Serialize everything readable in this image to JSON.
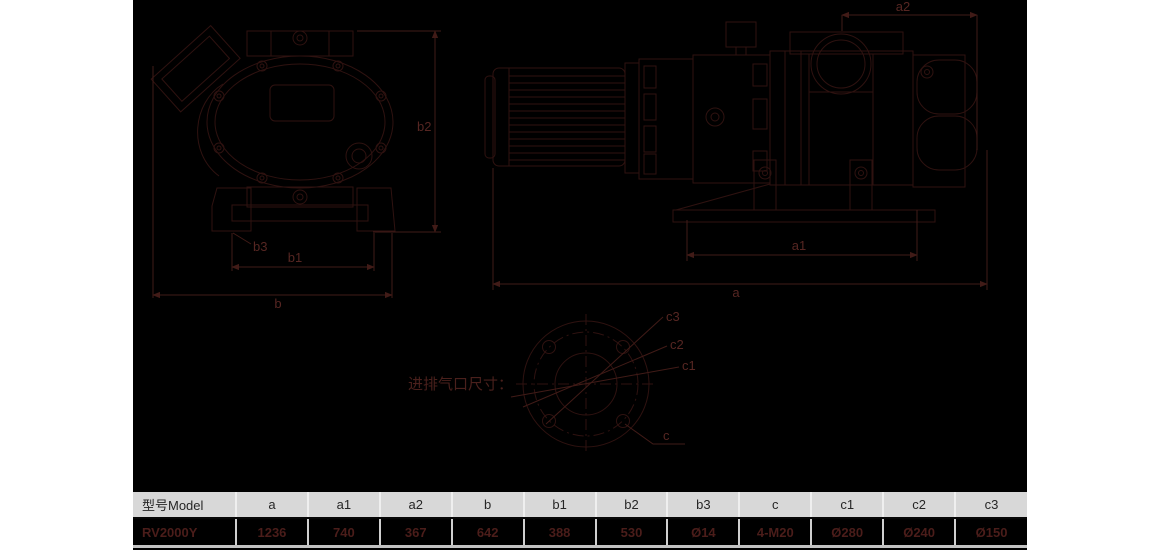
{
  "window": {
    "background": "#ffffff",
    "canvas_background": "#000000",
    "line_color": "#2f1210",
    "label_color": "#562622",
    "header_bg": "#d8d8d8",
    "value_text_color": "#4b1d1a"
  },
  "drawing": {
    "front_view": {
      "labels": {
        "b2": "b2",
        "b3": "b3",
        "b1": "b1",
        "b": "b"
      }
    },
    "side_view": {
      "labels": {
        "a2": "a2",
        "a1": "a1",
        "a": "a"
      }
    },
    "flange_view": {
      "caption": "进排气口尺寸：",
      "labels": {
        "c3": "c3",
        "c2": "c2",
        "c1": "c1",
        "c": "c"
      }
    }
  },
  "table": {
    "columns": [
      "型号Model",
      "a",
      "a1",
      "a2",
      "b",
      "b1",
      "b2",
      "b3",
      "c",
      "c1",
      "c2",
      "c3"
    ],
    "rows": [
      [
        "RV2000Y",
        "1236",
        "740",
        "367",
        "642",
        "388",
        "530",
        "Ø14",
        "4-M20",
        "Ø280",
        "Ø240",
        "Ø150"
      ]
    ]
  }
}
